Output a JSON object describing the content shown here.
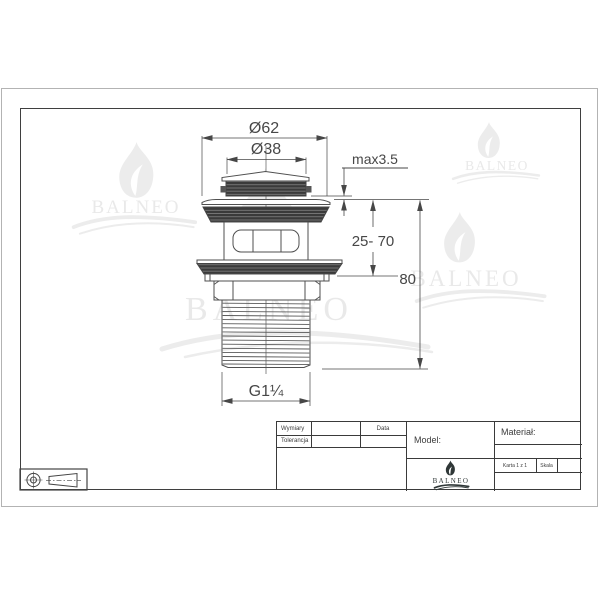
{
  "drawing": {
    "watermark_text": "BALNEO",
    "dimensions": {
      "flange_diameter": "Ø62",
      "cap_diameter": "Ø38",
      "max_thickness": "max3.5",
      "height_range": "25- 70",
      "total_height": "80",
      "thread_size": "G1¼"
    }
  },
  "title_block": {
    "wymiary_label": "Wymiary",
    "tolerancja_label": "Tolerancja",
    "data_label": "Data",
    "model_label": "Model:",
    "material_label": "Materiał:",
    "karta_label": "Karta 1 z 1",
    "skala_label": "Skala",
    "logo_text": "BALNEO"
  },
  "colors": {
    "line": "#4f4f4f",
    "dimension": "#474747",
    "dark_fill": "#3a3a3a",
    "watermark": "#e9e9e9",
    "frame": "#3f3f3f",
    "sheet_border": "#b3b3b3",
    "logo_dark": "#2f3737"
  }
}
